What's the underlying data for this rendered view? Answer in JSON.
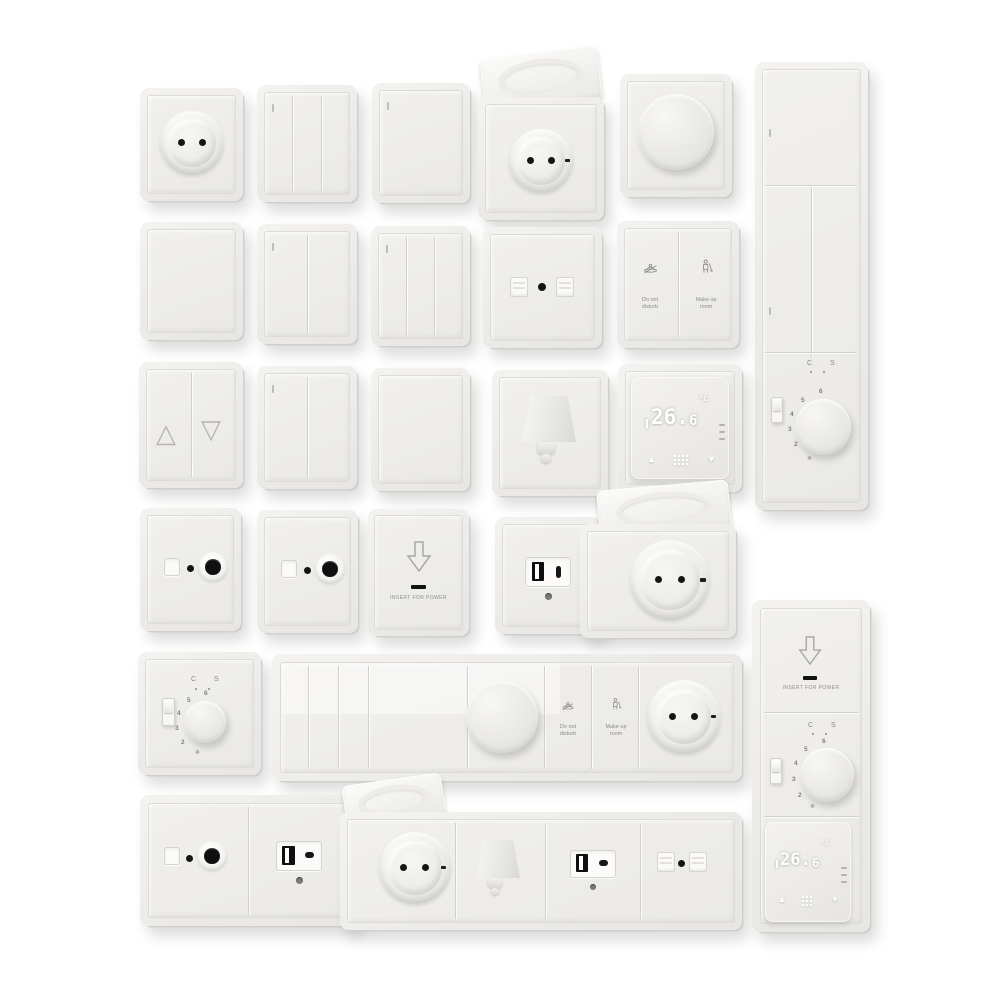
{
  "scene": {
    "description": "Product render: set of white electrical wall plates — sockets, rocker switches, dimmers, thermostats, hotel controls",
    "background": "#ffffff"
  },
  "colors": {
    "plate_face": "#efeeea",
    "plate_edge": "#d0cfcb",
    "detail_black": "#151515",
    "label_gray": "#8d8c88",
    "indicator_gray": "#b6bfc1",
    "display_digit_white": "#ffffff"
  },
  "labels": {
    "dnd_line1": "Do not",
    "dnd_line2": "disturb",
    "mur_line1": "Make up",
    "mur_line2": "room",
    "insert_for_power": "INSERT FOR POWER",
    "mode_cs": "C S"
  },
  "thermostat_display": {
    "reading_int": "26.",
    "reading_dec": "6",
    "unit": "°C"
  },
  "dial": {
    "n2": "2",
    "n3": "3",
    "n4": "4",
    "n5": "5",
    "n6": "6"
  },
  "icons": {
    "blinds_up": "△",
    "blinds_down": "▽",
    "snowflake": "❄",
    "thermostat_up": "▲",
    "thermostat_down": "▼",
    "insert_arrow": "hollow-down-arrow",
    "dnd_icon": "door-hanger-crossed",
    "mur_icon": "housekeeping-person",
    "menu_grid": "dot-grid"
  }
}
